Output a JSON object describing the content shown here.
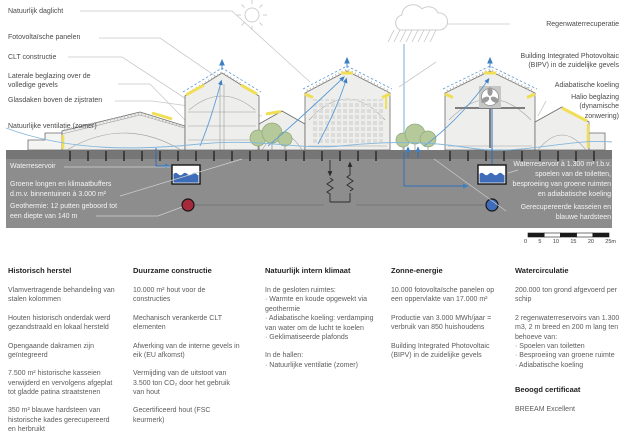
{
  "diagram": {
    "left_labels": [
      "Natuurlijk daglicht",
      "Fotovoltaïsche panelen",
      "CLT constructie",
      "Laterale beglazing over de\nvolledige gevels",
      "Glasdaken boven de zijstraten",
      "Natuurlijke ventilatie (zomer)"
    ],
    "right_labels": [
      "Regenwaterrecuperatie",
      "Building Integrated Photovoltaic\n(BIPV) in de zuidelijke gevels",
      "Adiabatische koeling",
      "Halio beglazing\n(dynamische\nzonwering)"
    ],
    "ground_left_labels": [
      "Waterreservoir",
      "Groene longen en klimaatbuffers\nd.m.v. binnentuinen à 3.000 m²",
      "Geothermie: 12 putten geboord tot\neen diepte van 140 m"
    ],
    "ground_right_labels": [
      "Waterreservoir à 1.300 m³ t.b.v.\nspoelen van de toiletten,\nbesproeiing van groene ruimten\nen adiabatische koeling",
      "Gerecupereerde kasseien en\nblauwe hardsteen"
    ],
    "scale_bar": {
      "labels": [
        "0",
        "5",
        "10",
        "15",
        "20",
        "25m"
      ]
    },
    "icons": {
      "sun": "sun-icon",
      "rain_cloud": "rain-cloud-icon",
      "water_reservoir": "water-reservoir-icon",
      "geothermal_warm_well": "warm-well-marker",
      "geothermal_cold_well": "cold-well-marker",
      "ventilation_fan": "fan-icon",
      "trees": "tree-icon"
    },
    "colors": {
      "underground_gray": "#8d8d8d",
      "street_gray": "#767676",
      "accent_yellow": "#f0de55",
      "airflow_blue": "#5b9bd5",
      "pipe_blue": "#2f6fbe",
      "warm_well_red": "#a52a3b",
      "cold_well_blue": "#3e6cb8"
    }
  },
  "columns": [
    {
      "title": "Historisch herstel",
      "paragraphs": [
        "Vlamvertragende behandeling van stalen kolommen",
        "Houten historisch onderdak werd gezandstraald en lokaal hersteld",
        "Opengaande dakramen zijn geïntegreerd",
        "7.500 m² historische kasseien verwijderd en vervolgens afgeplat tot gladde patina straatstenen",
        "350 m² blauwe hardsteen van historische kades gerecupereerd en herbruikt"
      ]
    },
    {
      "title": "Duurzame constructie",
      "paragraphs": [
        "10.000 m² hout voor de constructies",
        "Mechanisch verankerde CLT elementen",
        "Afwerking van de interne gevels in eik (EU afkomst)",
        "Vermijding van de uitstoot van 3.500 ton CO₂ door het gebruik van hout",
        "Gecertificeerd hout (FSC keurmerk)"
      ]
    },
    {
      "title": "Natuurlijk intern klimaat",
      "paragraphs": [
        "In de gesloten ruimtes:\n· Warmte en koude opgewekt via geothermie\n· Adiabatische koeling: verdamping van water om de lucht te koelen\n· Geklimatiseerde plafonds",
        "In de hallen:\n· Natuurlijke ventilatie (zomer)"
      ]
    },
    {
      "title": "Zonne-energie",
      "paragraphs": [
        "10.000 fotovoltaïsche panelen op een oppervlakte van 17.000 m²",
        "Productie van 3.000 MWh/jaar = verbruik van 850 huishoudens",
        "Building Integrated Photovoltaic (BIPV) in de zuidelijke gevels"
      ]
    },
    {
      "title": "Watercirculatie",
      "paragraphs": [
        "200.000 ton grond afgevoerd per schip",
        "2 regenwaterreservoirs van 1.300 m3, 2 m breed en 200 m lang ten behoeve van:\n· Spoelen van toiletten\n· Besproeiing van groene ruimte\n· Adiabatische koeling"
      ]
    }
  ],
  "certificate": {
    "title": "Beoogd certificaat",
    "value": "BREEAM Excellent"
  }
}
